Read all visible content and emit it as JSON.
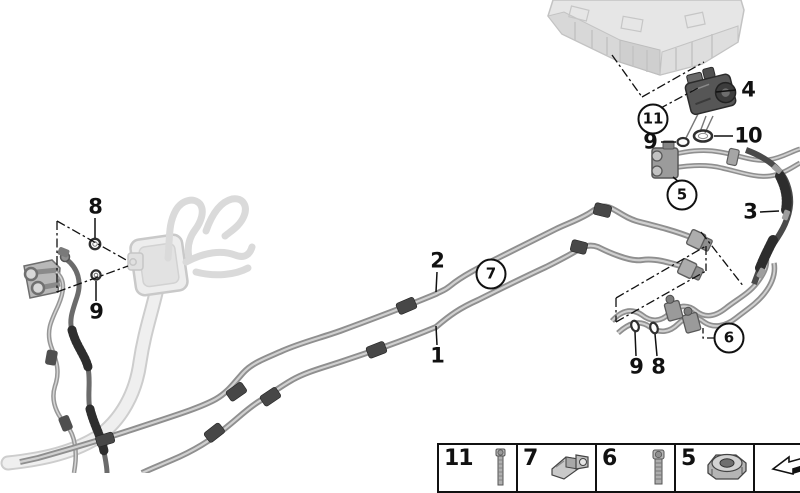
{
  "diagram": {
    "title": "Refrigerant lines underfloor parts diagram",
    "background_color": "#ffffff",
    "line_color": "#9a9a9a",
    "dark_hose_color": "#3a3a3a",
    "ghost_color": "#e3e3e3",
    "label_color": "#111111"
  },
  "callouts": {
    "c1": {
      "label": "1"
    },
    "c2": {
      "label": "2"
    },
    "c3": {
      "label": "3"
    },
    "c4": {
      "label": "4"
    },
    "c5": {
      "label": "5"
    },
    "c6": {
      "label": "6"
    },
    "c7": {
      "label": "7"
    },
    "c8_left": {
      "label": "8"
    },
    "c9_left": {
      "label": "9"
    },
    "c9_top": {
      "label": "9"
    },
    "c10": {
      "label": "10"
    },
    "c11": {
      "label": "11"
    },
    "c9_bottom": {
      "label": "9"
    },
    "c8_bottom": {
      "label": "8"
    }
  },
  "legend": {
    "items": [
      {
        "label": "11",
        "icon": "bolt-long-icon"
      },
      {
        "label": "7",
        "icon": "pipe-clamp-icon"
      },
      {
        "label": "6",
        "icon": "bolt-icon"
      },
      {
        "label": "5",
        "icon": "flange-nut-icon"
      },
      {
        "label": "",
        "icon": "direction-arrow-icon"
      }
    ]
  }
}
